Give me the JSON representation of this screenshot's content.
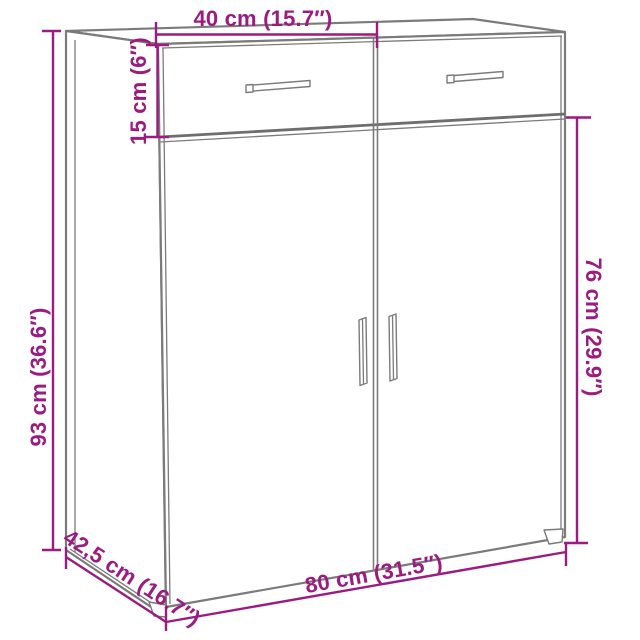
{
  "page": {
    "background": "#ffffff"
  },
  "colors": {
    "dimension_accent": "#9b1b80",
    "cabinet_outline": "#7b7b7b"
  },
  "diagram": {
    "kind": "furniture-dimension-diagram",
    "subject": "two-drawer two-door sideboard cabinet",
    "dimensions": {
      "drawer_section_width": {
        "label": "40 cm (15.7″)",
        "cm": "40",
        "inches": "15.7"
      },
      "drawer_height": {
        "label": "15 cm (6″)",
        "cm": "15",
        "inches": "6"
      },
      "total_height": {
        "label": "93 cm (36.6″)",
        "cm": "93",
        "inches": "36.6"
      },
      "door_section_height": {
        "label": "76 cm (29.9″)",
        "cm": "76",
        "inches": "29.9"
      },
      "depth": {
        "label": "42,5 cm (16.7″)",
        "cm": "42,5",
        "inches": "16.7"
      },
      "total_width": {
        "label": "80 cm (31.5″)",
        "cm": "80",
        "inches": "31.5"
      }
    }
  }
}
